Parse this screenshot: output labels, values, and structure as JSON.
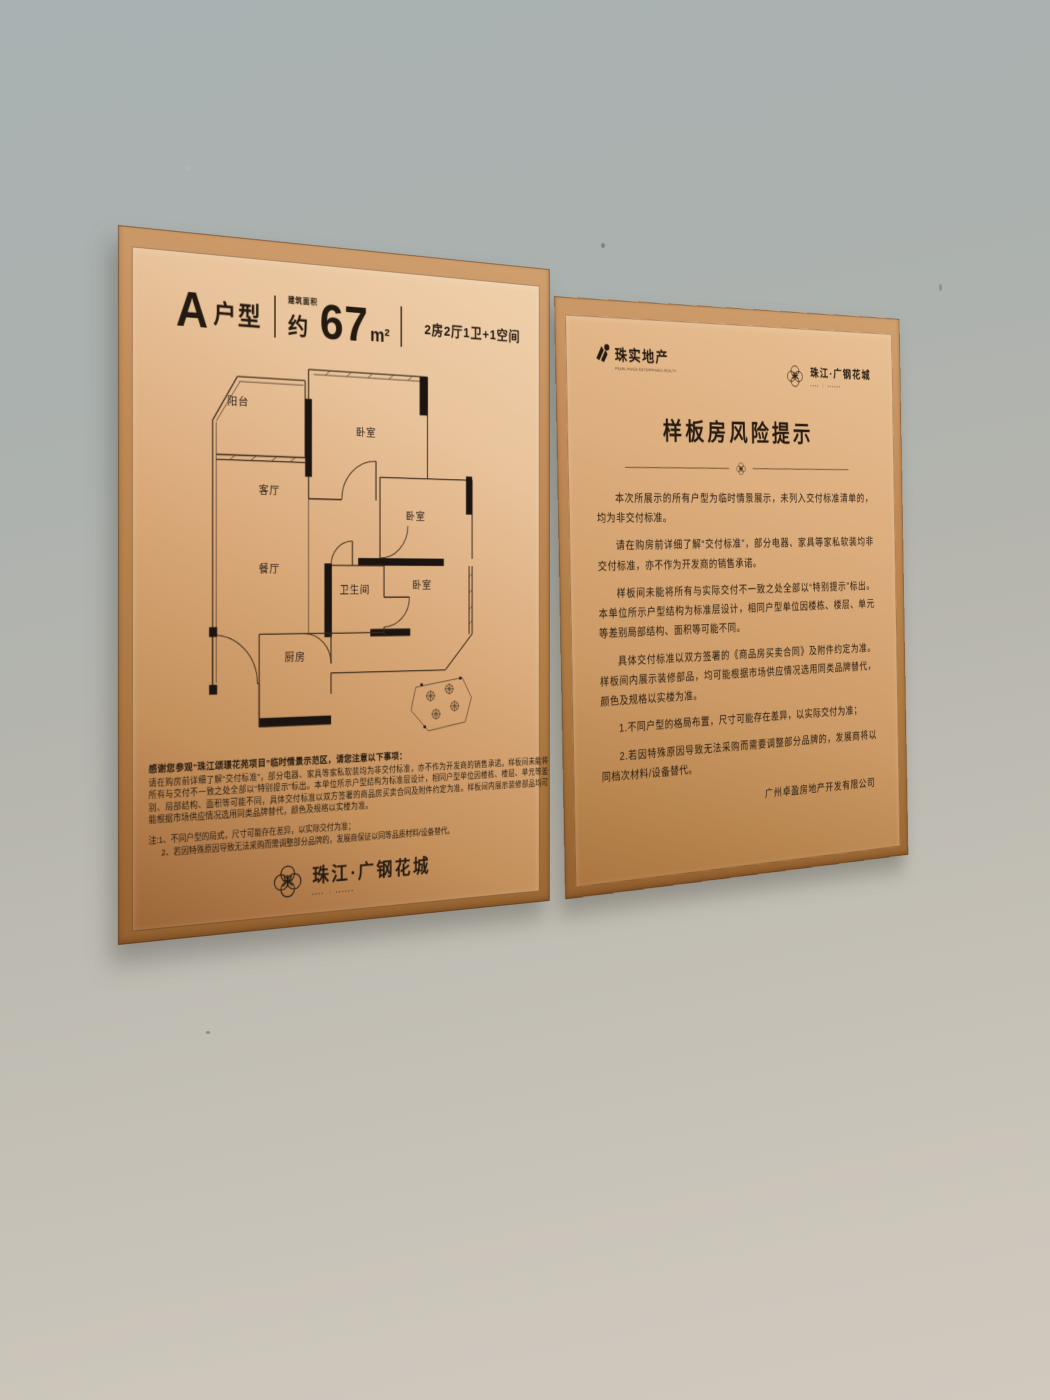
{
  "left_plaque": {
    "unit_name": "A",
    "unit_suffix": "户型",
    "area_label": "建筑面积",
    "area_prefix": "约",
    "area_value": "67",
    "area_unit": "m²",
    "layout_desc": "2房2厅1卫+1空间",
    "floorplan_rooms": [
      "阳台",
      "客厅",
      "卧室",
      "卧室",
      "餐厅",
      "卫生间",
      "卧室",
      "厨房"
    ],
    "disclaimer_heading": "感谢您参观“珠江颂璟花苑项目”临时情景示范区，请您注意以下事项：",
    "disclaimer_body": "请在购房前详细了解“交付标准”，部分电器、家具等家私软装均为非交付标准，亦不作为开发商的销售承诺。样板间未能将所有与交付不一致之处全部以“特别提示”标出。本单位所示户型结构为标准层设计，相同户型单位因楼栋、楼层、单元等差别、局部结构、面积等可能不同，具体交付标准以双方签署的商品房买卖合同及附件约定为准。样板间内展示装修部品均可能根据市场供应情况选用同类品牌替代，颜色及规格以实楼为准。",
    "note_line1": "注:1、不同户型的局式，尺寸可能存在差异，以实际交付为准；",
    "note_line2": "2、若因特殊原因导致无法采购而需调整部分品牌的，发展商保证以同等品质材料/设备替代。",
    "brand_name": "珠江·广钢花城",
    "brand_tagline": "▪▪▪▪ ｜ ▪▪▪▪▪▪"
  },
  "right_plaque": {
    "developer_name": "珠实地产",
    "developer_subtext": "PEARL RIVER ENTERPRISES REALTY",
    "brand_name": "珠江·广钢花城",
    "brand_tagline": "▪▪▪▪ ｜ ▪▪▪▪▪▪",
    "title": "样板房风险提示",
    "paragraphs": [
      "本次所展示的所有户型为临时情景展示，未列入交付标准清单的，均为非交付标准。",
      "请在购房前详细了解“交付标准”，部分电器、家具等家私软装均非交付标准，亦不作为开发商的销售承诺。",
      "样板间未能将所有与实际交付不一致之处全部以“特别提示”标出。本单位所示户型结构为标准层设计，相同户型单位因楼栋、楼层、单元等差别局部结构、面积等可能不同。",
      "具体交付标准以双方签署的《商品房买卖合同》及附件约定为准。样板间内展示装修部品，均可能根据市场供应情况选用同类品牌替代，颜色及规格以实楼为准。",
      "1.不同户型的格局布置，尺寸可能存在差异，以实际交付为准；",
      "2.若因特殊原因导致无法采购而需要调整部分品牌的，发展商将以同档次材料/设备替代。"
    ],
    "signature": "广州卓盈房地产开发有限公司"
  }
}
